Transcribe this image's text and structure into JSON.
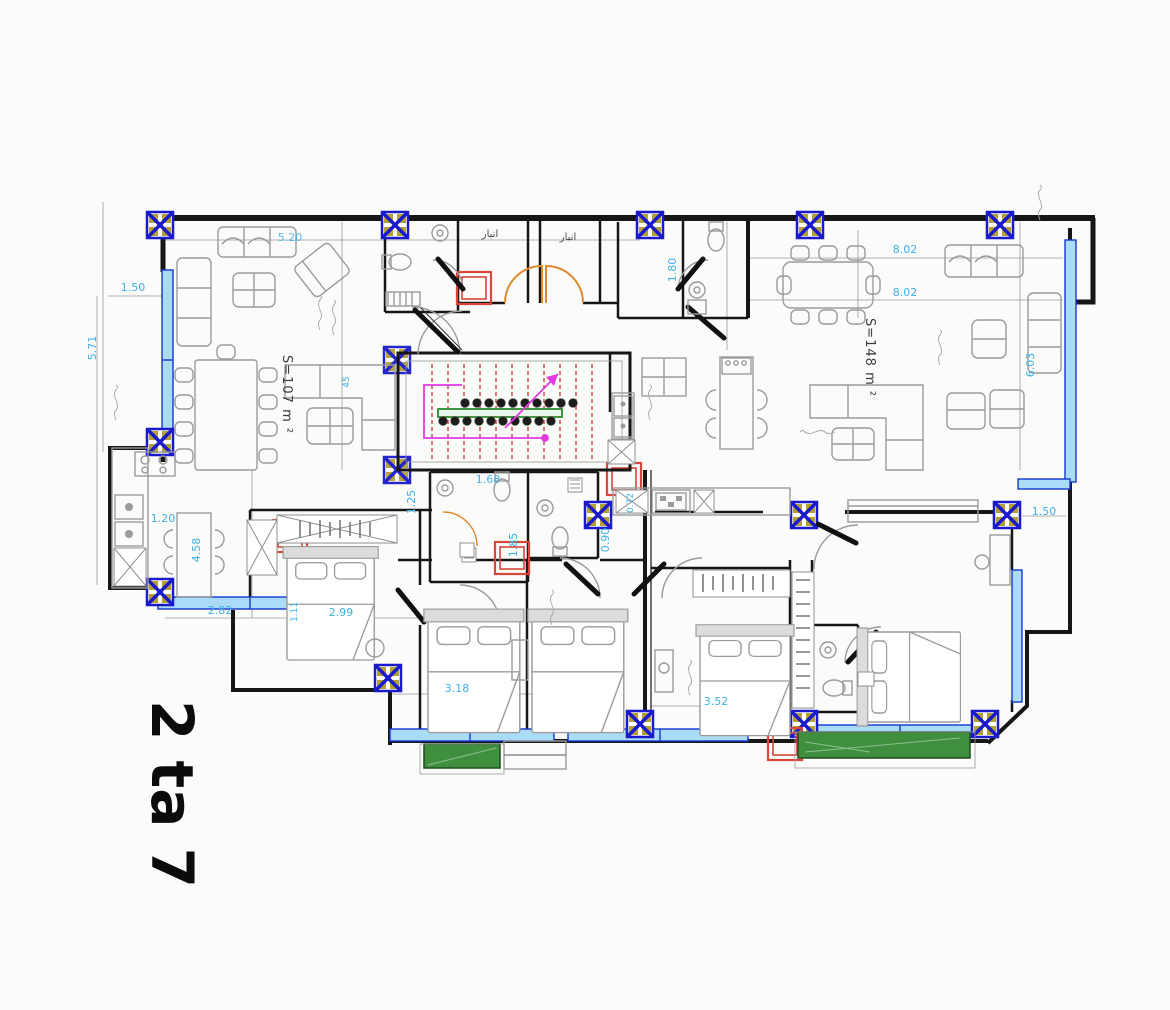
{
  "title_label": "2 ta 7",
  "areas": {
    "left_apartment": "S=107 m ²",
    "right_apartment": "S=148 m ²"
  },
  "room_labels": {
    "storage_1": "انبار",
    "storage_2": "انبار"
  },
  "dims": {
    "terrace_width": "1.50",
    "terrace_height": "5.71",
    "living_width": "5.20",
    "right_span_a": "8.02",
    "right_span_b": "8.02",
    "hall_height": "1.80",
    "right_height": "6.03",
    "kitchen_width": "1.20",
    "kitchen_height": "4.58",
    "note_45": "45",
    "bed1_offset": "2.82",
    "bed1_width": "2.99",
    "bed1_side": "1.11",
    "stair_side": "1.25",
    "bath_width": "1.68",
    "bath_height": "1.85",
    "corridor_a": "0.90",
    "corridor_b": "0.72",
    "bed2_width": "3.18",
    "bed4_width": "3.52",
    "terrace_right": "1.50"
  },
  "colors": {
    "dimension_cyan": "#3eb1e8",
    "column_blue": "#1a1acc",
    "column_yellow": "#b3a033",
    "window_fill": "#aadcf7",
    "shaft_red": "#d9463c",
    "door_orange": "#e08a2e",
    "stair_tread_red": "#cc3333",
    "stair_path_magenta": "#e43ae4",
    "handrail_green": "#2e8b2e",
    "planter_green": "#3f8f3f"
  }
}
